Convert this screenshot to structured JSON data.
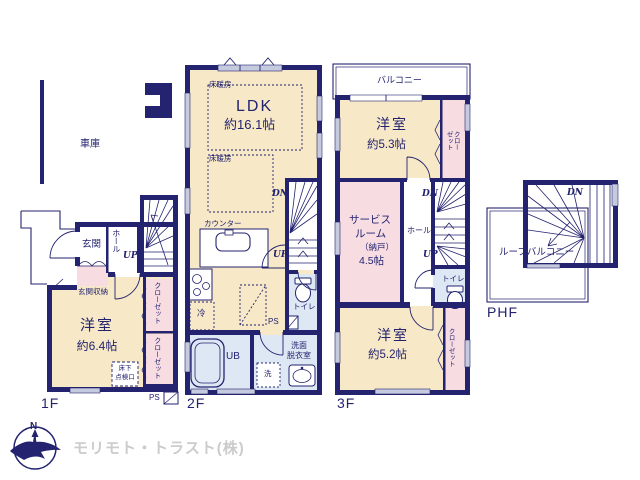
{
  "colors": {
    "wall": "#23236f",
    "room_beige": "#f7e8c7",
    "closet_pink": "#f7dce2",
    "wet_blue": "#dde8f4",
    "window": "#c6cadf",
    "company_gray": "#cbcbcb"
  },
  "garage": {
    "label": "車庫"
  },
  "floor1": {
    "label": "1F",
    "genkan": "玄関",
    "hall": "ホール",
    "up": "UP",
    "genkan_storage": "玄関収納",
    "room_name": "洋室",
    "room_size": "約6.4帖",
    "closet1": "クローゼット",
    "closet2": "クローゼット",
    "floor_hatch_line1": "床下",
    "floor_hatch_line2": "点検口",
    "ps": "PS"
  },
  "floor2": {
    "label": "2F",
    "floor_heating1": "床暖房",
    "floor_heating2": "床暖房",
    "ldk_name": "LDK",
    "ldk_size": "約16.1帖",
    "dn": "DN",
    "up": "UP",
    "counter": "カウンター",
    "fridge": "冷",
    "toilet": "トイレ",
    "ps": "PS",
    "bath": "UB",
    "washroom_line1": "洗面",
    "washroom_line2": "脱衣室",
    "washer": "洗"
  },
  "floor3": {
    "label": "3F",
    "balcony": "バルコニー",
    "room1_name": "洋室",
    "room1_size": "約5.3帖",
    "closet_top": "クローゼット",
    "service_line1": "サービス",
    "service_line2": "ルーム",
    "service_line3": "（納戸）",
    "service_line4": "4.5帖",
    "hall": "ホール",
    "dn": "DN",
    "up": "UP",
    "toilet": "トイレ",
    "room2_name": "洋室",
    "room2_size": "約5.2帖",
    "closet_bottom": "クローゼット"
  },
  "phf": {
    "label": "PHF",
    "dn": "DN",
    "roof_balcony": "ルーフバルコニー"
  },
  "footer": {
    "compass_n": "N",
    "company": "モリモト・トラスト(株)"
  }
}
